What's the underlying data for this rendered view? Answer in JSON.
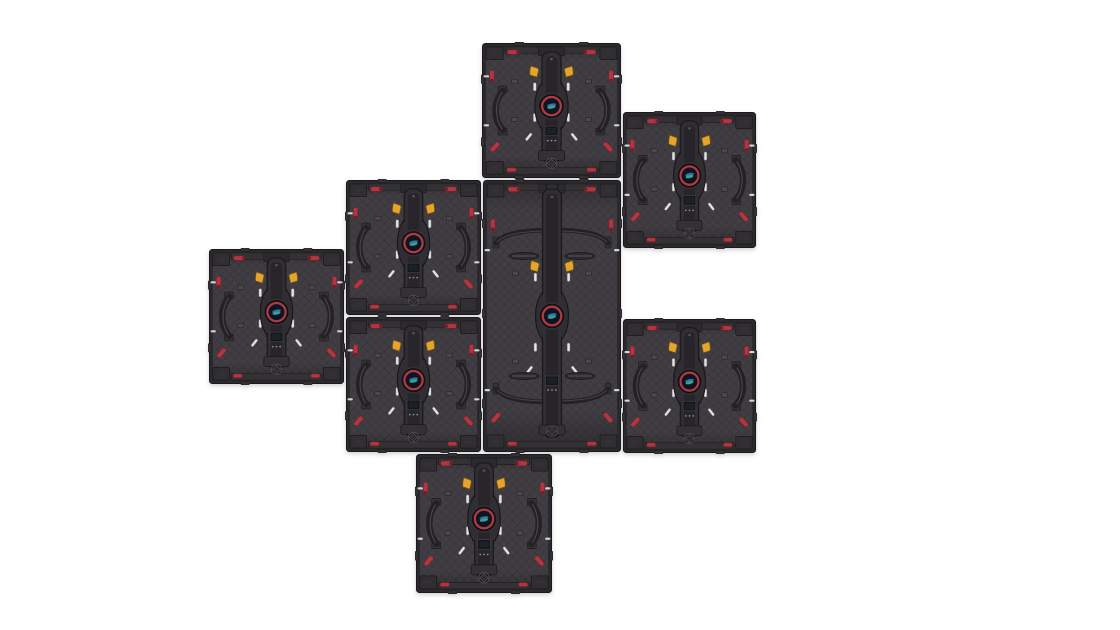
{
  "scene": {
    "kind": "product-render",
    "subject": "rear view of modular LED display cabinets spliced together in a staggered cross-shaped mosaic",
    "background_color": "#ffffff",
    "stage": {
      "width": 1120,
      "height": 630
    }
  },
  "palette": {
    "bg": "#ffffff",
    "frame": "#2b292c",
    "outline": "#1a191b",
    "body": "#403e42",
    "quiltLine": "#363438",
    "trim": "#333134",
    "corner": "#302e31",
    "handle": "#232124",
    "handleHi": "#56545a",
    "spine": "#302e32",
    "spineOut": "#19181b",
    "spineIn": "#27252a",
    "hubRim": "#121114",
    "hubIn": "#0e1520",
    "redRing": "#b03a44",
    "logoBlue": "#3272aa",
    "logoTeal": "#3fa08c",
    "clip": "#e5a42d",
    "clipDark": "#71520e",
    "red": "#b23540",
    "redDark": "#731f2b",
    "pin": "#e3e2e4",
    "pinEdge": "#77757a",
    "block": "#4a484c",
    "screen": "#151417",
    "screenEdge": "#403e42",
    "dot": "#8f8f92"
  },
  "panels": [
    {
      "id": "cabinet-top-center",
      "type": "square",
      "x": 481,
      "y": 42,
      "w": 141,
      "h": 137
    },
    {
      "id": "cabinet-upper-right",
      "type": "square",
      "x": 622,
      "y": 111,
      "w": 135,
      "h": 138
    },
    {
      "id": "cabinet-mid-left",
      "type": "square",
      "x": 345,
      "y": 179,
      "w": 137,
      "h": 137
    },
    {
      "id": "cabinet-center-tall",
      "type": "tall",
      "x": 482,
      "y": 179,
      "w": 140,
      "h": 274
    },
    {
      "id": "cabinet-far-left",
      "type": "square",
      "x": 208,
      "y": 248,
      "w": 137,
      "h": 137
    },
    {
      "id": "cabinet-lower-left",
      "type": "square",
      "x": 345,
      "y": 316,
      "w": 137,
      "h": 137
    },
    {
      "id": "cabinet-mid-right",
      "type": "square",
      "x": 622,
      "y": 318,
      "w": 135,
      "h": 136
    },
    {
      "id": "cabinet-bottom",
      "type": "square",
      "x": 415,
      "y": 453,
      "w": 138,
      "h": 141
    }
  ]
}
